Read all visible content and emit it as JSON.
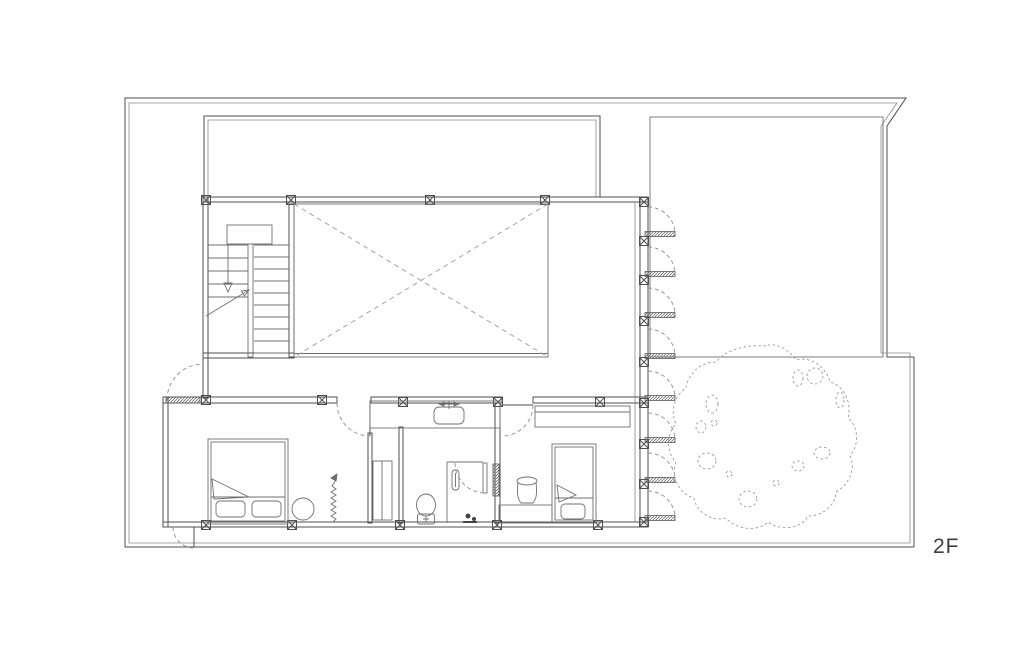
{
  "canvas": {
    "width": 1024,
    "height": 651,
    "background": "#ffffff"
  },
  "palette": {
    "wall_line": "#4f4f4f",
    "furniture_line": "#6f6f6f",
    "dashed_line": "#8f8f8f",
    "deck_line": "#9a9a9a",
    "tree_line": "#9a9a9a",
    "hatch_fill": "#6a6a6a",
    "label_text": "#3f3f3f"
  },
  "plan": {
    "floor_label": "2F",
    "drawing_type": "architectural-floor-plan",
    "elements": [
      "site-boundary",
      "roof-terrace",
      "void-opening",
      "staircase",
      "wood-deck",
      "louver-doors",
      "garden",
      "tree",
      "bedroom-main",
      "washroom",
      "bathroom",
      "bedroom-second"
    ],
    "furniture": [
      "double-bed",
      "round-stool",
      "plant",
      "wardrobe",
      "vanity-counter",
      "sink",
      "toilet",
      "shower",
      "single-bed",
      "desk",
      "stool",
      "closet"
    ]
  }
}
